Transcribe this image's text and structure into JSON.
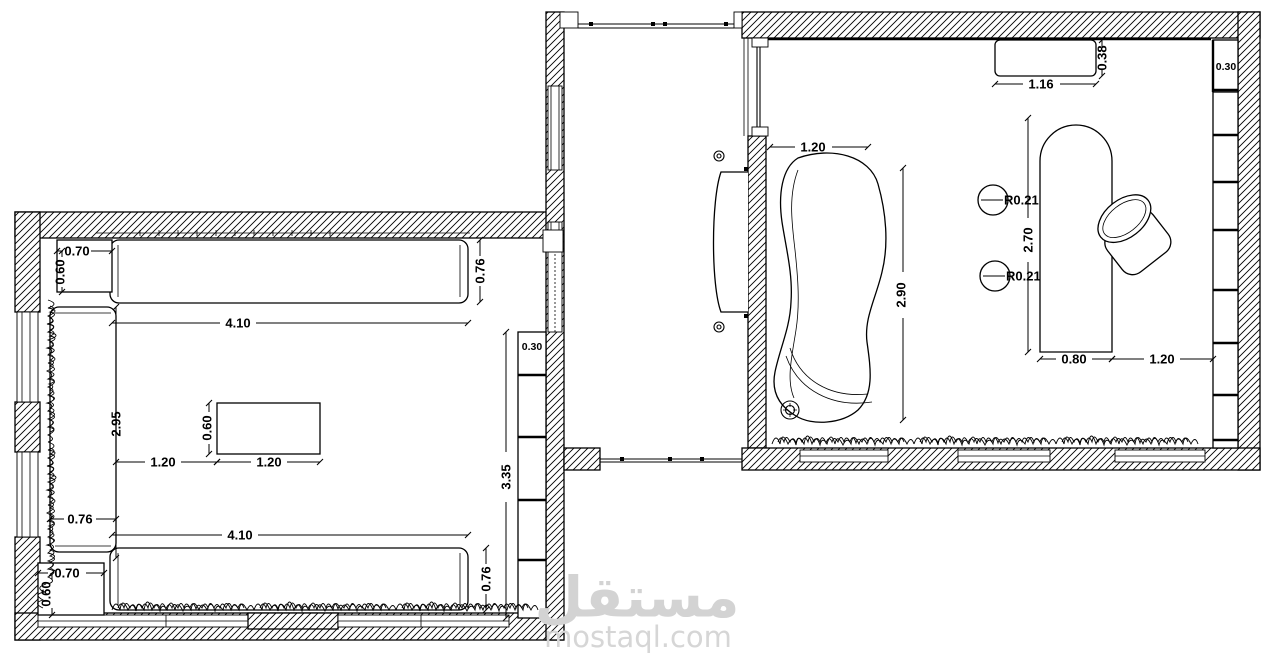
{
  "watermark": {
    "arabic": "مستقل",
    "domain": "mostaql.com"
  },
  "left_room": {
    "top_side_table": {
      "width": "0.70",
      "depth": "0.60"
    },
    "top_sofa": {
      "length": "4.10",
      "depth": "0.76"
    },
    "left_sofa": {
      "length": "2.95",
      "depth": "0.76"
    },
    "center_table": {
      "width": "1.20",
      "depth": "0.60",
      "gap": "1.20"
    },
    "bottom_sofa": {
      "length": "4.10",
      "depth": "0.76"
    },
    "bottom_side_table": {
      "width": "0.70",
      "depth": "0.60"
    },
    "shelf": {
      "span": "3.35",
      "depth": "0.30"
    }
  },
  "hall": {
    "door_opening": "1.20"
  },
  "right_room": {
    "console": {
      "width": "1.16",
      "depth": "0.38"
    },
    "shelf": {
      "depth": "0.30"
    },
    "sofa": {
      "length": "2.90"
    },
    "desk": {
      "length": "2.70",
      "width": "0.80",
      "clearance": "1.20"
    },
    "stool_top": {
      "radius": "R0.21"
    },
    "stool_bottom": {
      "radius": "R0.21"
    }
  }
}
